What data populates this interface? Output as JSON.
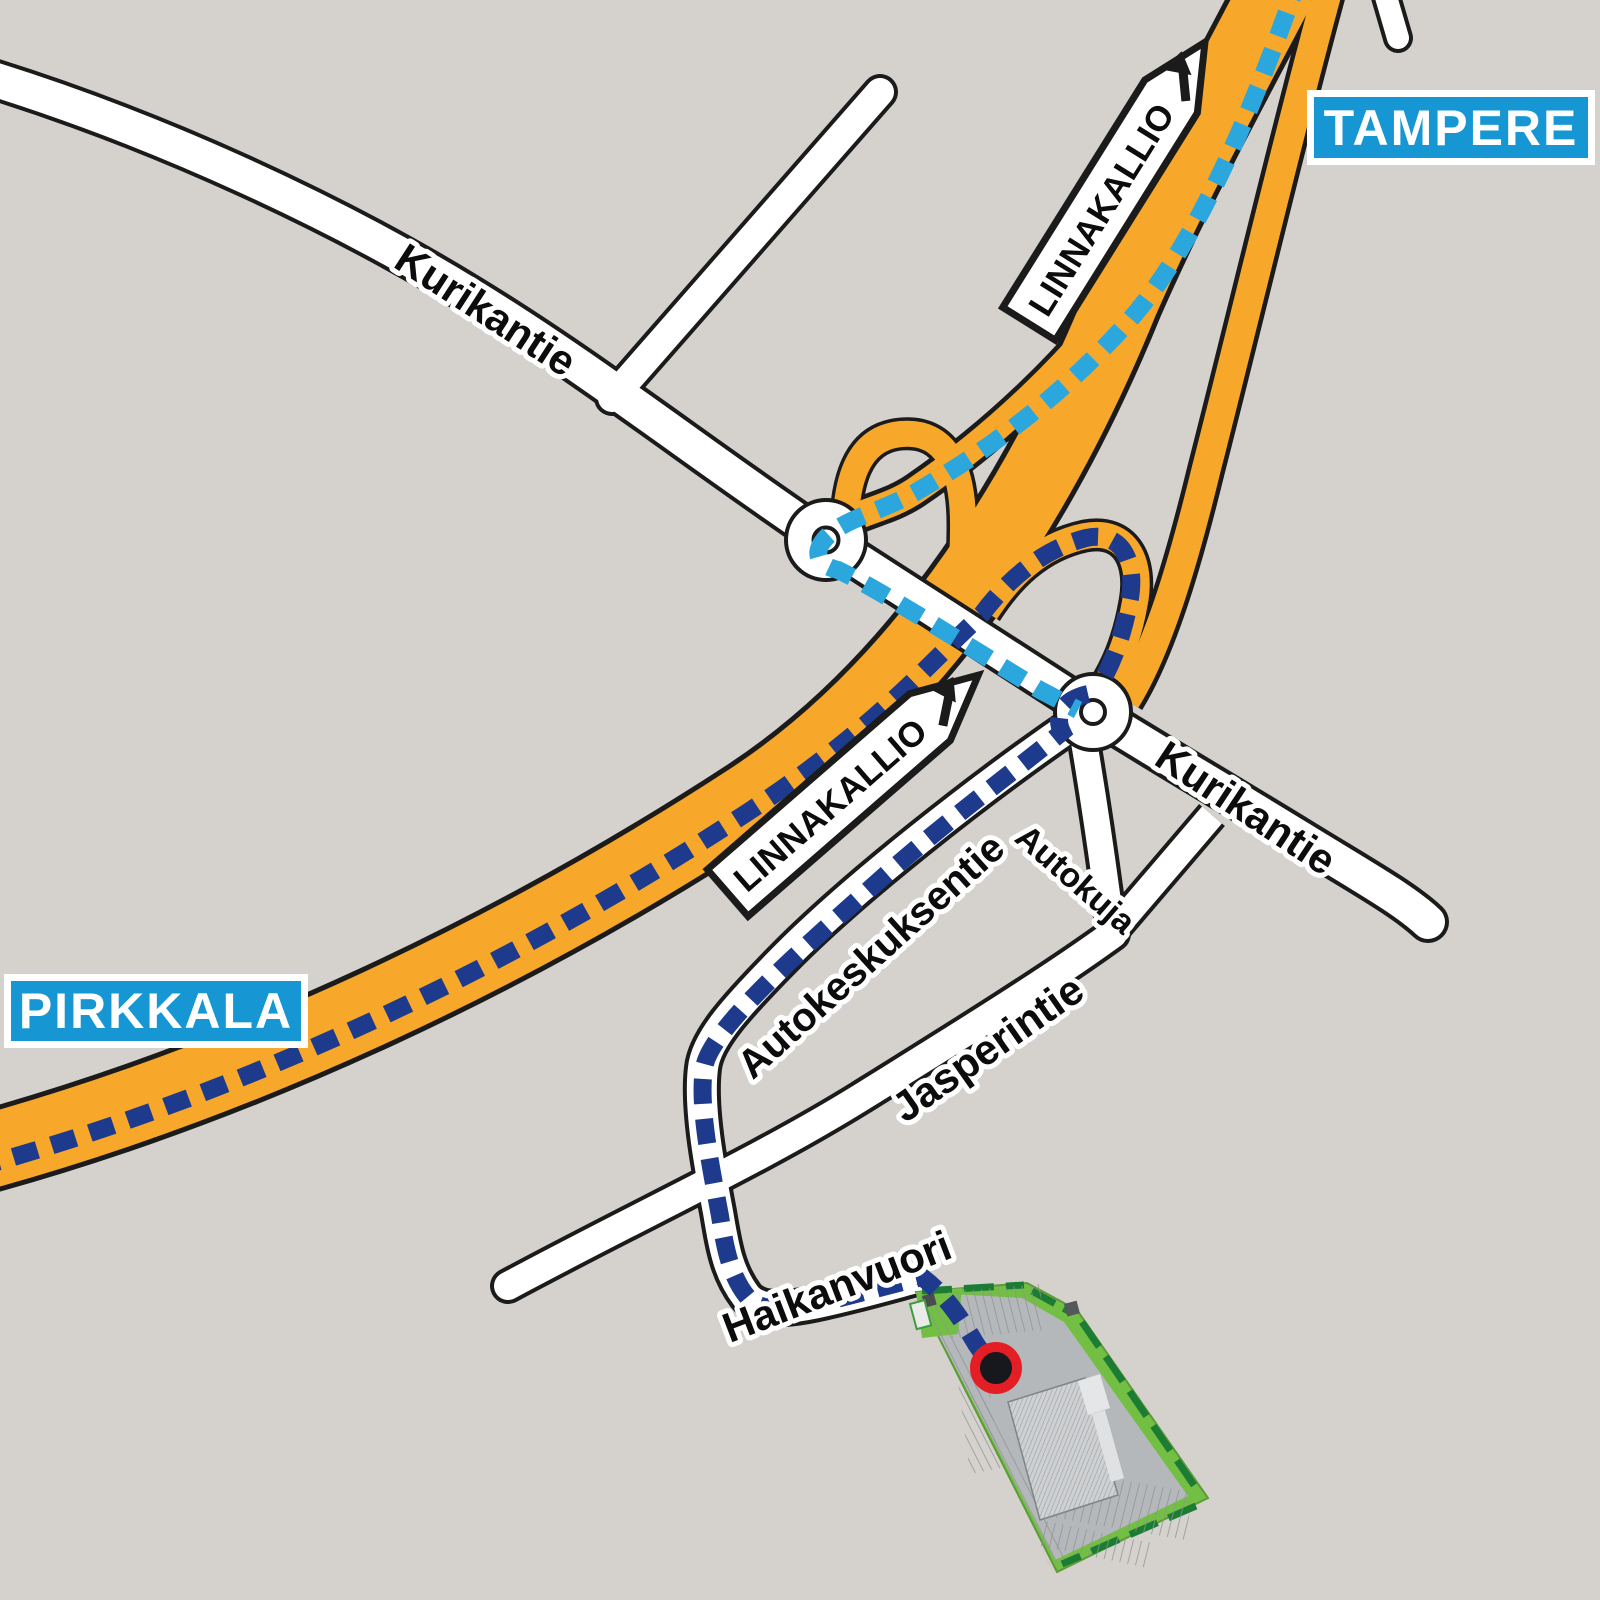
{
  "background": "#d5d2ce",
  "cities": {
    "tampere": "TAMPERE",
    "pirkkala": "PIRKKALA",
    "badge_color": "#1697d4",
    "badge_text_color": "#ffffff"
  },
  "direction_signs": {
    "north": "LINNAKALLIO",
    "south": "LINNAKALLIO",
    "arrow": "up-right"
  },
  "roads": {
    "kurikantie_nw": "Kurikantie",
    "kurikantie_se": "Kurikantie",
    "autokeskuksentie": "Autokeskuksentie",
    "autokuja": "Autokuja",
    "jasperintie": "Jasperintie",
    "haikanvuori": "Haikanvuori"
  },
  "highway": {
    "color": "#f7a82a"
  },
  "routes": {
    "from_tampere_color": "#2ba7de",
    "from_pirkkala_color": "#1e3a8c"
  },
  "site": {
    "green": "#72bf44",
    "green_dark": "#1c7c33",
    "gray": "#b5b8bb",
    "building_gray": "#ced0d2"
  },
  "marker": {
    "ring_color": "#e41e25",
    "fill_color": "#16181d"
  }
}
